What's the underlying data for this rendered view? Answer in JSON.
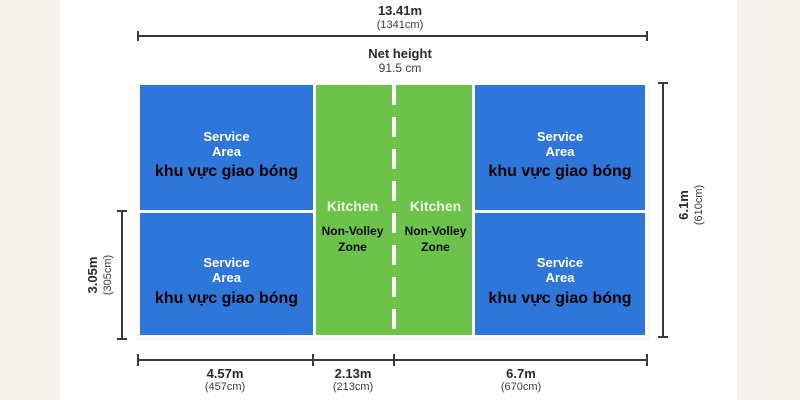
{
  "colors": {
    "background": "#f6f3ee",
    "panel": "#ffffff",
    "court_blue": "#2f76db",
    "kitchen_green": "#6cc24a",
    "court_lines": "#ffffff",
    "dimension_lines": "#3a3a3a",
    "text_dark": "#2a2a2a"
  },
  "dimensions": {
    "top": {
      "m": "13.41m",
      "cm": "(1341cm)"
    },
    "net": {
      "label": "Net height",
      "value": "91.5 cm"
    },
    "left": {
      "m": "3.05m",
      "cm": "(305cm)"
    },
    "right": {
      "m": "6.1m",
      "cm": "(610cm)"
    },
    "bottom": [
      {
        "m": "4.57m",
        "cm": "(457cm)"
      },
      {
        "m": "2.13m",
        "cm": "(213cm)"
      },
      {
        "m": "6.7m",
        "cm": "(670cm)"
      }
    ]
  },
  "court": {
    "service_areas": [
      {
        "position": "top-left",
        "line1": "Service",
        "line2": "Area",
        "sublabel": "khu vực giao bóng"
      },
      {
        "position": "top-right",
        "line1": "Service",
        "line2": "Area",
        "sublabel": "khu vực giao bóng"
      },
      {
        "position": "bottom-left",
        "line1": "Service",
        "line2": "Area",
        "sublabel": "khu vực giao bóng"
      },
      {
        "position": "bottom-right",
        "line1": "Service",
        "line2": "Area",
        "sublabel": "khu vực giao bóng"
      }
    ],
    "kitchen_zones": [
      {
        "position": "left",
        "title": "Kitchen",
        "sub1": "Non-Volley",
        "sub2": "Zone"
      },
      {
        "position": "right",
        "title": "Kitchen",
        "sub1": "Non-Volley",
        "sub2": "Zone"
      }
    ]
  }
}
